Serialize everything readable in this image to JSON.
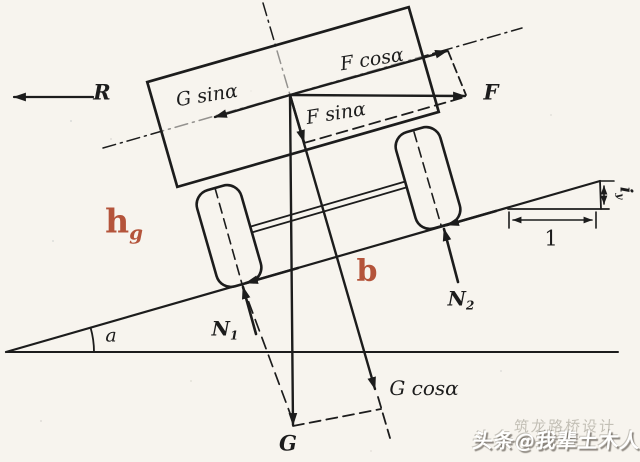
{
  "figure": {
    "colors": {
      "paper": "#f7f4ee",
      "ink": "#1c1c1c",
      "accent_red": "#b4543b",
      "watermark_white": "#ffffff"
    },
    "labels": {
      "resistance": "R",
      "g_sin": "G sinα",
      "f_cos": "F cosα",
      "f_sin": "F sinα",
      "force_f": "F",
      "gravity": "G",
      "g_cos": "G cosα",
      "n1": {
        "base": "N",
        "sub": "1"
      },
      "n2": {
        "base": "N",
        "sub": "2"
      },
      "slope_angle": "a",
      "cg_height": {
        "base": "h",
        "sub": "g"
      },
      "axle_distance": "b",
      "grade_rise": {
        "base": "i",
        "sub": "y"
      },
      "grade_run": "1"
    },
    "watermark": {
      "primary": "头条@我辈土木人",
      "secondary": "筑龙路桥设计"
    }
  }
}
